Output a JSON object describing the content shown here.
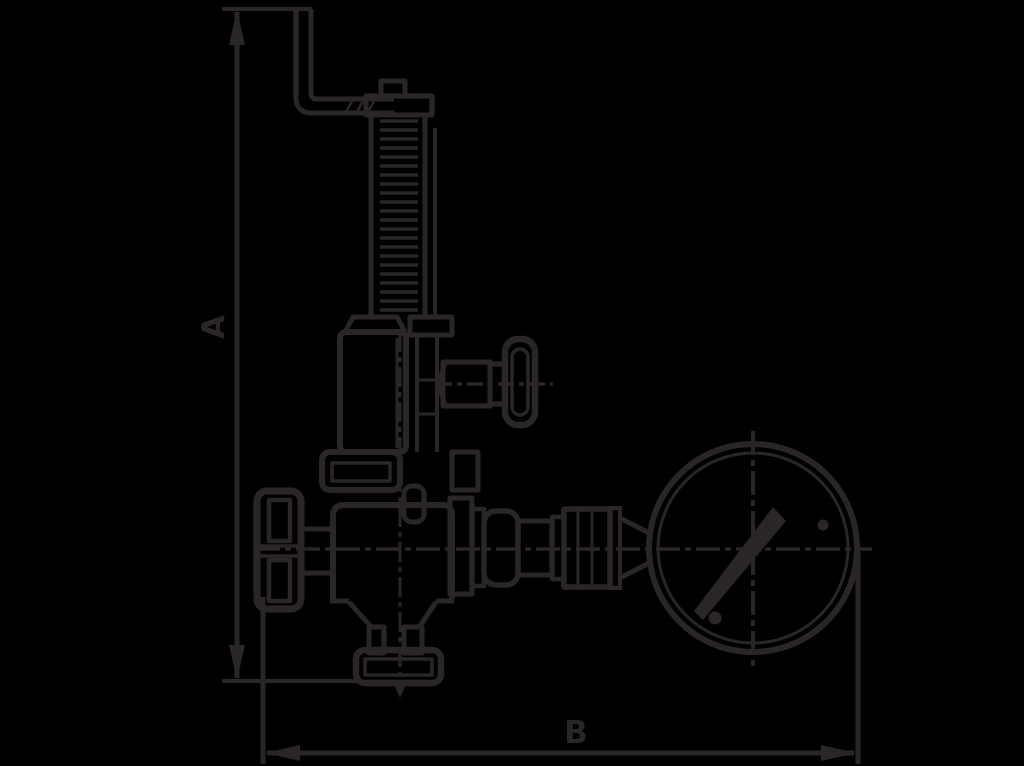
{
  "canvas": {
    "background_color": "#000000",
    "line_color": "#2a2628"
  },
  "drawing": {
    "kind": "technical-dimension-line-drawing",
    "subject": "spring-loaded valve with test lever, shut-off handwheel and pressure gauge",
    "dimension_labels": {
      "height": "A",
      "width": "B"
    },
    "parts": [
      "test-lever",
      "spindle-spring",
      "spring-housing",
      "test-knob",
      "handwheel",
      "valve-body",
      "outlet-flange",
      "gauge-coupling",
      "pressure-gauge"
    ]
  }
}
